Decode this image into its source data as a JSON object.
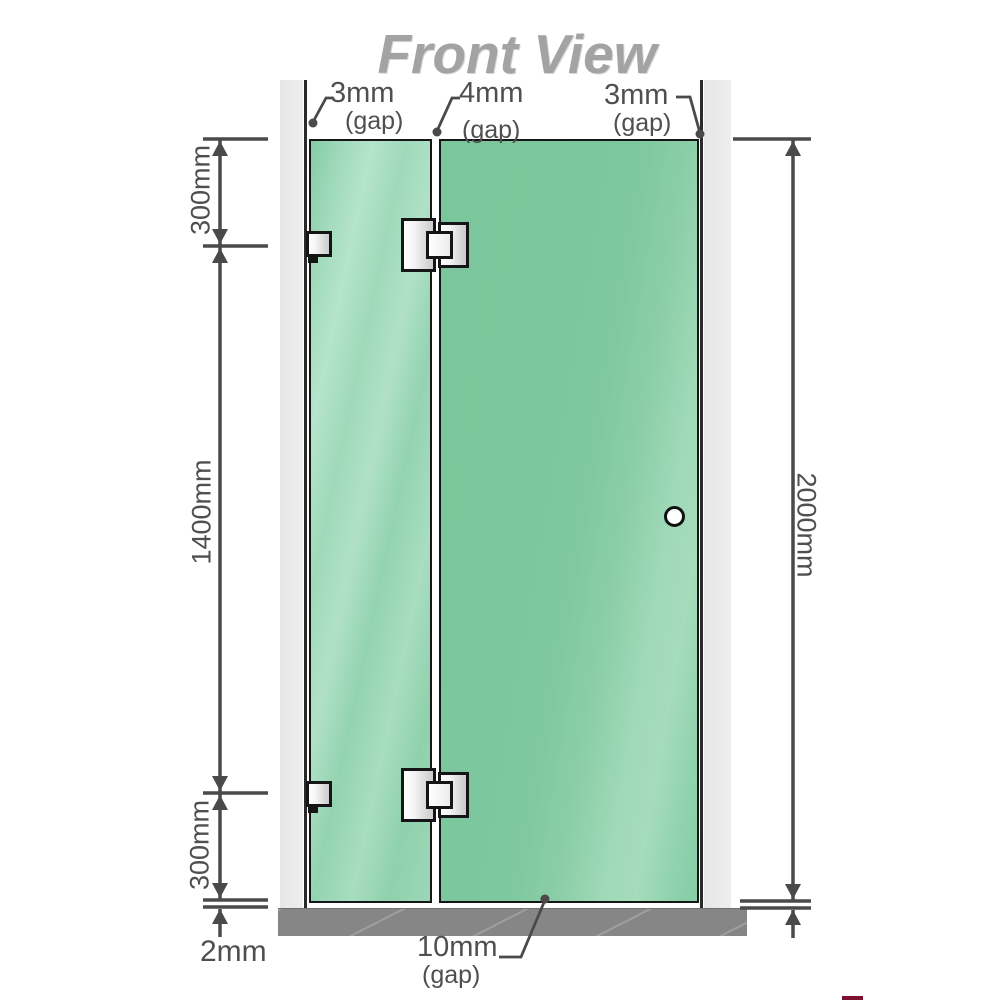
{
  "title": "Front View",
  "diagram": {
    "type": "shower-screen-front-view",
    "gaps": {
      "top_left": {
        "value": "3mm",
        "label": "(gap)"
      },
      "top_middle": {
        "value": "4mm",
        "label": "(gap)"
      },
      "top_right": {
        "value": "3mm",
        "label": "(gap)"
      },
      "bottom": {
        "value": "10mm",
        "label": "(gap)"
      },
      "floor": {
        "value": "2mm"
      }
    },
    "dimensions": {
      "left_top": "300mm",
      "left_middle": "1400mm",
      "left_bottom": "300mm",
      "right_total": "2000mm"
    },
    "colors": {
      "glass": "#7ec89f",
      "glass_highlight": "#b5e4cb",
      "wall": "#e9e9e9",
      "floor": "#868686",
      "dimension_line": "#4a4a4a",
      "label_text": "#4f4f4f",
      "title_text": "#a3a3a3",
      "hardware_border": "#151515"
    }
  }
}
